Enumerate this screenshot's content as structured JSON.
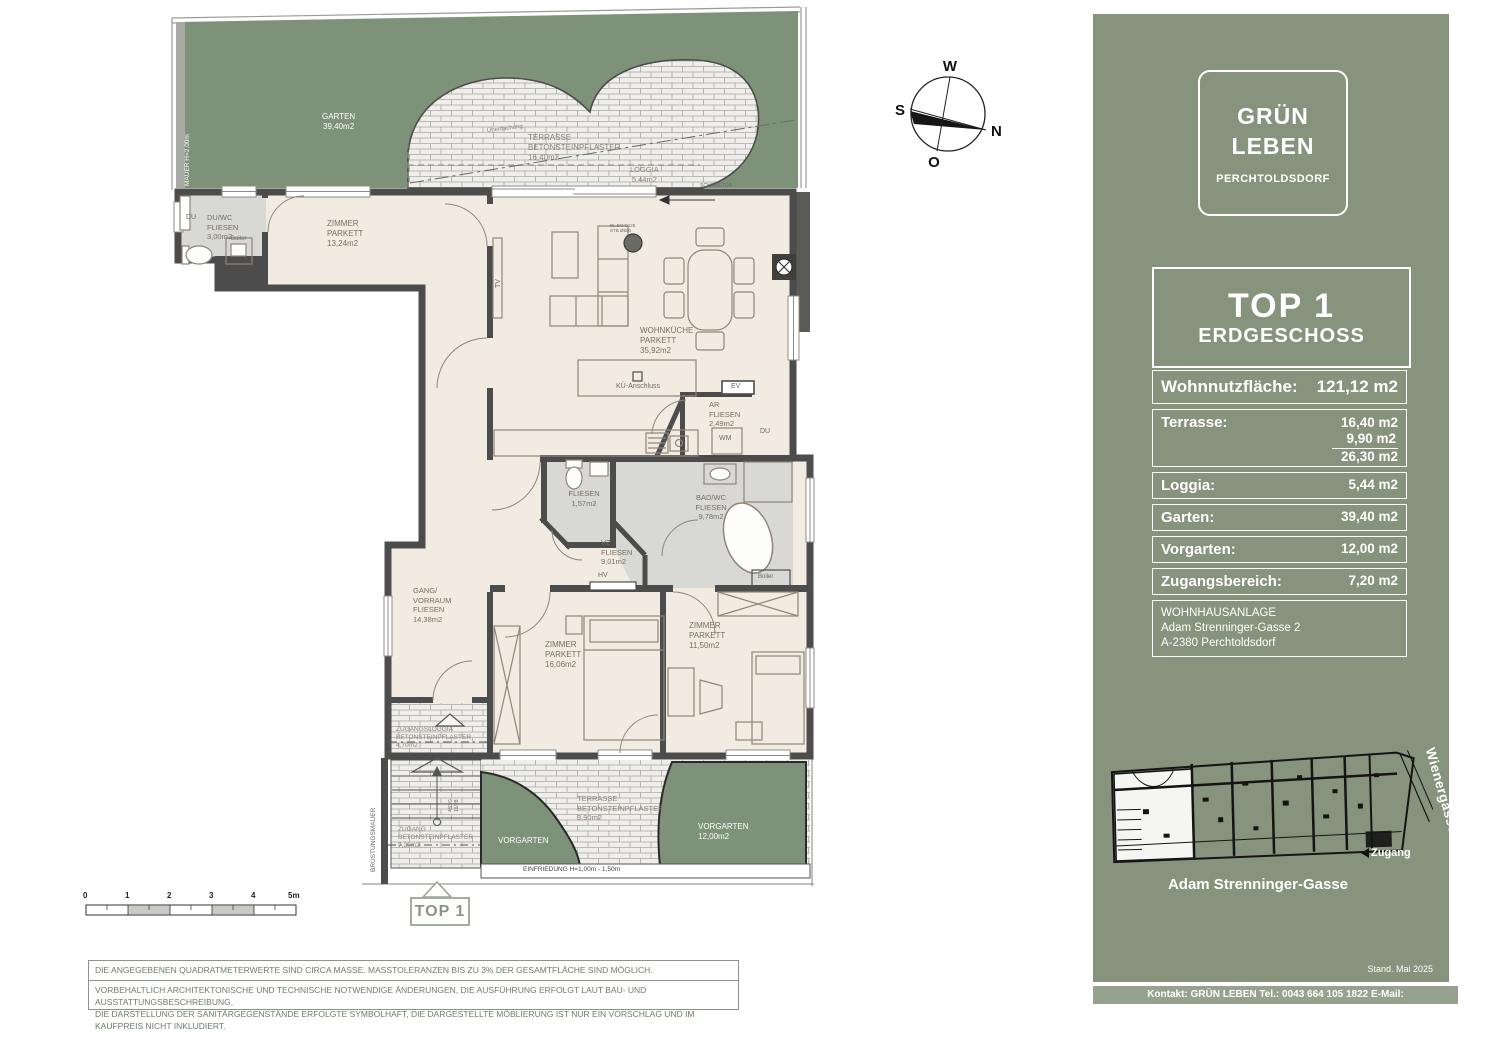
{
  "plan": {
    "labels": {
      "garten": "GARTEN\n39,40m2",
      "mauer": "MAUER H=2,00m",
      "terrasse_top": "TERRASSE\nBETONSTEINPFLASTER\n16,40m2",
      "ueberdachung": "Überdachung",
      "loggia": "LOGGIA\n5,44m2",
      "schiebetuer": "SCHIEBETÜR",
      "du_top": "DU",
      "duwc": "DU/WC\nFLIESEN\n3,00m2",
      "boiler_top": "Boiler",
      "zimmer1": "ZIMMER\nPARKETT\n13,24m2",
      "column_note": "BL.Bst.D125\nSTB Ø500",
      "tv": "TV",
      "wohnkueche": "WOHNKÜCHE\nPARKETT\n35,92m2",
      "kue_anschluss": "KÜ-Anschluss",
      "ev": "EV",
      "ar": "AR\nFLIESEN\n2,49m2",
      "wm": "WM",
      "du_bad": "DU",
      "wc_fliesen": "FLIESEN\n1,57m2",
      "badwc": "BAD/WC\nFLIESEN\n9,78m2",
      "boiler_bad": "Boiler",
      "vz": "VZ\nFLIESEN\n9,01m2",
      "hv": "HV",
      "gang": "GANG/\nVORRAUM\nFLIESEN\n14,38m2",
      "zimmer2": "ZIMMER\nPARKETT\n16,06m2",
      "zimmer3": "ZIMMER\nPARKETT\n11,50m2",
      "zugangsloggia": "ZUGANGSLOGGIA\nBETONSTEINPFLASTER\n4,70m2",
      "bruestungsmauer": "BRÜSTUNGSMAUER",
      "zugang": "ZUGANG\nBETONSTEINPFLASTER\n7,20m2",
      "stiege": "4STG.\n16/28",
      "vorgarten_links": "VORGARTEN",
      "terrasse_unten": "TERRASSE\nBETONSTEINPFLASTER\n9,90m2",
      "vorgarten_rechts": "VORGARTEN\n12,00m2",
      "einfriedung": "EINFRIEDUNG H=1,00m - 1,50m"
    },
    "marker": {
      "top1": "TOP 1"
    },
    "scale": {
      "ticks": [
        "0",
        "1",
        "2",
        "3",
        "4",
        "5m"
      ]
    },
    "disclaimers": {
      "line1": "DIE ANGEGEBENEN QUADRATMETERWERTE SIND CIRCA MASSE.  MASSTOLERANZEN BIS ZU 3% DER GESAMTFLÄCHE SIND MÖGLICH.",
      "line2": "VORBEHALTLICH ARCHITEKTONISCHE UND TECHNISCHE NOTWENDIGE ÄNDERUNGEN, DIE AUSFÜHRUNG ERFOLGT LAUT BAU- UND AUSSTATTUNGSBESCHREIBUNG,\nDIE DARSTELLUNG DER SANITÄRGEGENSTÄNDE ERFOLGTE SYMBOLHAFT, DIE DARGESTELLTE MÖBLIERUNG IST NUR EIN VORSCHLAG UND IM KAUFPREIS NICHT INKLUDIERT."
    }
  },
  "compass": {
    "n": "N",
    "o": "O",
    "s": "S",
    "w": "W"
  },
  "sidebar": {
    "logo": {
      "line1": "GRÜN",
      "line2": "LEBEN",
      "line3": "PERCHTOLDSDORF"
    },
    "unit": {
      "title": "TOP 1",
      "subtitle": "ERDGESCHOSS"
    },
    "areas": {
      "main_label": "Wohnnutzfläche:",
      "main_value": "121,12 m2",
      "terrasse": {
        "label": "Terrasse:",
        "v1": "16,40 m2",
        "v2": "9,90 m2",
        "sum": "26,30 m2"
      },
      "rows": [
        {
          "label": "Loggia:",
          "value": "5,44 m2"
        },
        {
          "label": "Garten:",
          "value": "39,40 m2"
        },
        {
          "label": "Vorgarten:",
          "value": "12,00 m2"
        },
        {
          "label": "Zugangsbereich:",
          "value": "7,20 m2"
        }
      ],
      "address": "WOHNHAUSANLAGE\nAdam Strenninger-Gasse 2\nA-2380 Perchtoldsdorf"
    },
    "siteplan": {
      "street_right": "Wienergasse",
      "zugang": "Zugang",
      "street_bottom": "Adam Strenninger-Gasse"
    },
    "stand": "Stand.  Mai 2025",
    "kontakt": "Kontakt:  GRÜN LEBEN  Tel.: 0043 664 105 1822   E-Mail: kontakt@gruenleben.at"
  },
  "colors": {
    "green_sidebar": "#86937d",
    "green_garden": "#7e9179",
    "band": "#96a28d",
    "wall": "#4c4c4c",
    "room": "#f1ebe2",
    "wet_room": "#d8d8d5"
  }
}
